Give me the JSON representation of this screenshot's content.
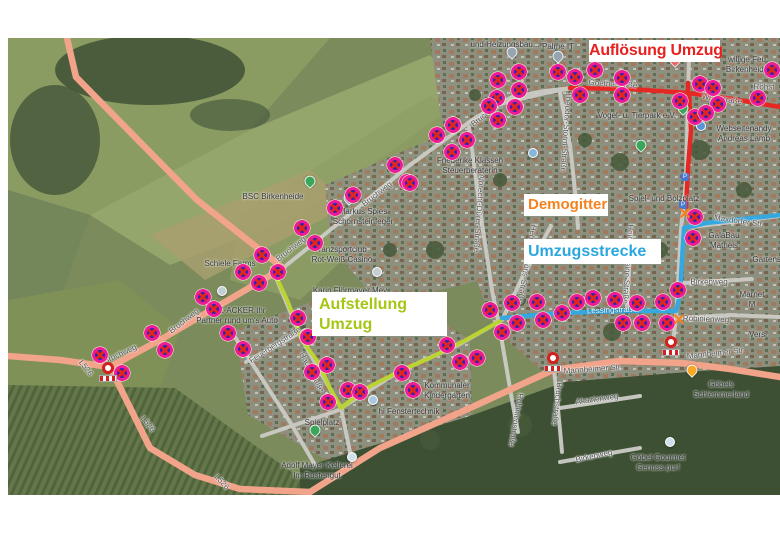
{
  "annotations": {
    "aufloesung": {
      "label": "Auflösung Umzug",
      "color": "#e8201f"
    },
    "demogitter": {
      "label": "Demogitter",
      "color": "#f6821f"
    },
    "umzugsstrecke": {
      "label": "Umzugsstrecke",
      "color": "#2aa7df"
    },
    "aufstellung": {
      "label": "Aufstellung Umzug",
      "line1": "Aufstellung",
      "line2": "Umzug",
      "color": "#a5c614"
    }
  },
  "routes": [
    {
      "name": "Auflösung Umzug",
      "color": "#e52823"
    },
    {
      "name": "Umzugsstrecke",
      "color": "#35a8e0"
    },
    {
      "name": "Aufstellung Umzug",
      "color": "#bcd431"
    }
  ],
  "street_labels": [
    {
      "t": "Goethestraße",
      "x": 613,
      "y": 84,
      "r": 4
    },
    {
      "t": "Waldstraße",
      "x": 722,
      "y": 99,
      "r": 8
    },
    {
      "t": "Theodor-Storm-Straße",
      "x": 566,
      "y": 132,
      "r": 94
    },
    {
      "t": "Bruchweg",
      "x": 486,
      "y": 114,
      "r": -38
    },
    {
      "t": "Bruchweg",
      "x": 377,
      "y": 194,
      "r": -38
    },
    {
      "t": "Bruchweg",
      "x": 291,
      "y": 249,
      "r": -38
    },
    {
      "t": "Bruchweg",
      "x": 184,
      "y": 321,
      "r": -38
    },
    {
      "t": "Bruchweg",
      "x": 120,
      "y": 354,
      "r": -25
    },
    {
      "t": "L526",
      "x": 86,
      "y": 368,
      "r": 52
    },
    {
      "t": "L526",
      "x": 148,
      "y": 424,
      "r": 52
    },
    {
      "t": "L526",
      "x": 222,
      "y": 482,
      "r": 48
    },
    {
      "t": "Mannheimer Str.",
      "x": 593,
      "y": 369,
      "r": -4
    },
    {
      "t": "Mannheimer Str.",
      "x": 716,
      "y": 353,
      "r": -6
    },
    {
      "t": "Lessingstraße",
      "x": 612,
      "y": 310,
      "r": -2,
      "light": true
    },
    {
      "t": "Maxdorfer Str.",
      "x": 739,
      "y": 221,
      "r": 8
    },
    {
      "t": "Albrecht-Dürer-Straße",
      "x": 479,
      "y": 213,
      "r": 94
    },
    {
      "t": "Hermann-Löns-Straße",
      "x": 527,
      "y": 264,
      "r": 100
    },
    {
      "t": "Heinrich-Heine-Straße",
      "x": 628,
      "y": 264,
      "r": 94
    },
    {
      "t": "Bruchstraße",
      "x": 557,
      "y": 404,
      "r": 97
    },
    {
      "t": "Robinienstraße",
      "x": 516,
      "y": 420,
      "r": 100
    },
    {
      "t": "Robinienweg",
      "x": 706,
      "y": 319,
      "r": 2
    },
    {
      "t": "Birkenweg",
      "x": 709,
      "y": 282,
      "r": 0
    },
    {
      "t": "Birkenweg",
      "x": 594,
      "y": 456,
      "r": -12
    },
    {
      "t": "Akazienweg",
      "x": 597,
      "y": 399,
      "r": -8
    },
    {
      "t": "Feuerbergstraße",
      "x": 275,
      "y": 345,
      "r": -33
    },
    {
      "t": "Hauptstraße",
      "x": 312,
      "y": 372,
      "r": 62
    },
    {
      "t": "Röhst",
      "x": 764,
      "y": 87,
      "r": 0
    }
  ],
  "place_labels": [
    {
      "lines": [
        "und Heizungsbau..."
      ],
      "x": 505,
      "y": 45
    },
    {
      "lines": [
        "Palme IT"
      ],
      "x": 558,
      "y": 47
    },
    {
      "lines": [
        "willige Feu",
        "Birkenheide"
      ],
      "x": 747,
      "y": 65
    },
    {
      "lines": [
        "Vogel- u. Tierpark e.V."
      ],
      "x": 637,
      "y": 116
    },
    {
      "lines": [
        "Webseitenandy",
        "Andreas Lamb"
      ],
      "x": 744,
      "y": 134
    },
    {
      "lines": [
        "Spiel- und Bolzplatz"
      ],
      "x": 664,
      "y": 199
    },
    {
      "lines": [
        "Friederike Klassen",
        "Steuerberaterin"
      ],
      "x": 470,
      "y": 166
    },
    {
      "lines": [
        "BSC Birkenheide"
      ],
      "x": 273,
      "y": 197
    },
    {
      "lines": [
        "Markus Spies",
        "Schornsteinfeger"
      ],
      "x": 363,
      "y": 217
    },
    {
      "lines": [
        "Tanzsportclub",
        "Rot-Weiß Casino"
      ],
      "x": 342,
      "y": 255
    },
    {
      "lines": [
        "Schiele Farms"
      ],
      "x": 230,
      "y": 264
    },
    {
      "lines": [
        "KFZ-ACKER Ihr",
        "Partner rund um's Auto"
      ],
      "x": 237,
      "y": 316
    },
    {
      "lines": [
        "Karin Flörmayer Mey..."
      ],
      "x": 353,
      "y": 291
    },
    {
      "lines": [
        "GalaBau Matheis"
      ],
      "x": 724,
      "y": 241
    },
    {
      "lines": [
        "Gartenstraße"
      ],
      "x": 776,
      "y": 260
    },
    {
      "lines": [
        "Marnet M"
      ],
      "x": 752,
      "y": 300
    },
    {
      "lines": [
        "Versi"
      ],
      "x": 758,
      "y": 335
    },
    {
      "lines": [
        "Kommunaler",
        "Kindergarten"
      ],
      "x": 447,
      "y": 391
    },
    {
      "lines": [
        "hi Fenstertechnik"
      ],
      "x": 409,
      "y": 412
    },
    {
      "lines": [
        "Spielplatz"
      ],
      "x": 322,
      "y": 423
    },
    {
      "lines": [
        "Adolf Mayer Kellerei",
        "Im Rustengut"
      ],
      "x": 317,
      "y": 471
    },
    {
      "lines": [
        "Göbels Schlemmerland"
      ],
      "x": 721,
      "y": 390
    },
    {
      "lines": [
        "Göbel Gourmet",
        "Genuss pur!"
      ],
      "x": 658,
      "y": 463
    }
  ],
  "markers": {
    "no_stopping": [
      [
        498,
        80
      ],
      [
        497,
        98
      ],
      [
        519,
        72
      ],
      [
        519,
        90
      ],
      [
        515,
        107
      ],
      [
        489,
        106
      ],
      [
        558,
        72
      ],
      [
        575,
        77
      ],
      [
        595,
        70
      ],
      [
        580,
        95
      ],
      [
        622,
        78
      ],
      [
        622,
        95
      ],
      [
        700,
        84
      ],
      [
        713,
        88
      ],
      [
        680,
        101
      ],
      [
        718,
        104
      ],
      [
        695,
        117
      ],
      [
        706,
        113
      ],
      [
        772,
        70
      ],
      [
        758,
        98
      ],
      [
        498,
        120
      ],
      [
        467,
        140
      ],
      [
        453,
        125
      ],
      [
        437,
        135
      ],
      [
        452,
        152
      ],
      [
        407,
        182
      ],
      [
        395,
        165
      ],
      [
        410,
        183
      ],
      [
        353,
        195
      ],
      [
        335,
        208
      ],
      [
        302,
        228
      ],
      [
        315,
        243
      ],
      [
        278,
        272
      ],
      [
        262,
        255
      ],
      [
        243,
        272
      ],
      [
        259,
        283
      ],
      [
        203,
        297
      ],
      [
        214,
        309
      ],
      [
        100,
        355
      ],
      [
        122,
        373
      ],
      [
        152,
        333
      ],
      [
        165,
        350
      ],
      [
        228,
        333
      ],
      [
        243,
        349
      ],
      [
        298,
        318
      ],
      [
        308,
        337
      ],
      [
        327,
        365
      ],
      [
        312,
        372
      ],
      [
        328,
        402
      ],
      [
        348,
        390
      ],
      [
        360,
        392
      ],
      [
        402,
        373
      ],
      [
        413,
        390
      ],
      [
        447,
        345
      ],
      [
        460,
        362
      ],
      [
        477,
        358
      ],
      [
        490,
        310
      ],
      [
        502,
        332
      ],
      [
        512,
        303
      ],
      [
        517,
        323
      ],
      [
        537,
        302
      ],
      [
        543,
        320
      ],
      [
        562,
        313
      ],
      [
        577,
        302
      ],
      [
        593,
        298
      ],
      [
        615,
        300
      ],
      [
        623,
        323
      ],
      [
        637,
        303
      ],
      [
        642,
        323
      ],
      [
        663,
        302
      ],
      [
        667,
        323
      ],
      [
        678,
        290
      ],
      [
        695,
        217
      ],
      [
        693,
        238
      ]
    ],
    "closures": [
      [
        108,
        372
      ],
      [
        553,
        362
      ],
      [
        671,
        346
      ]
    ],
    "x_marks": [
      [
        685,
        215
      ],
      [
        679,
        321
      ]
    ],
    "parking_signs": [
      [
        685,
        177
      ],
      [
        683,
        205
      ]
    ]
  },
  "pins": [
    {
      "x": 512,
      "y": 56,
      "c": "#97a5b1",
      "s": "drop"
    },
    {
      "x": 558,
      "y": 60,
      "c": "#97a5b1",
      "s": "drop"
    },
    {
      "x": 675,
      "y": 64,
      "c": "#e8696b",
      "s": "drop"
    },
    {
      "x": 683,
      "y": 112,
      "c": "#3ba55c",
      "s": "drop"
    },
    {
      "x": 701,
      "y": 126,
      "c": "#5a93d6",
      "s": "dot"
    },
    {
      "x": 641,
      "y": 149,
      "c": "#3ba55c",
      "s": "drop"
    },
    {
      "x": 533,
      "y": 153,
      "c": "#86b7da",
      "s": "dot"
    },
    {
      "x": 310,
      "y": 185,
      "c": "#3ba55c",
      "s": "drop"
    },
    {
      "x": 349,
      "y": 202,
      "c": "#97a5b1",
      "s": "drop"
    },
    {
      "x": 377,
      "y": 272,
      "c": "#c2cdd4",
      "s": "dot"
    },
    {
      "x": 222,
      "y": 291,
      "c": "#c2cdd4",
      "s": "dot"
    },
    {
      "x": 373,
      "y": 400,
      "c": "#a9c8de",
      "s": "dot"
    },
    {
      "x": 315,
      "y": 434,
      "c": "#3ba55c",
      "s": "drop"
    },
    {
      "x": 352,
      "y": 457,
      "c": "#cfe0ea",
      "s": "dot"
    },
    {
      "x": 692,
      "y": 374,
      "c": "#f9a825",
      "s": "drop"
    },
    {
      "x": 670,
      "y": 442,
      "c": "#cfe0ea",
      "s": "dot"
    }
  ]
}
